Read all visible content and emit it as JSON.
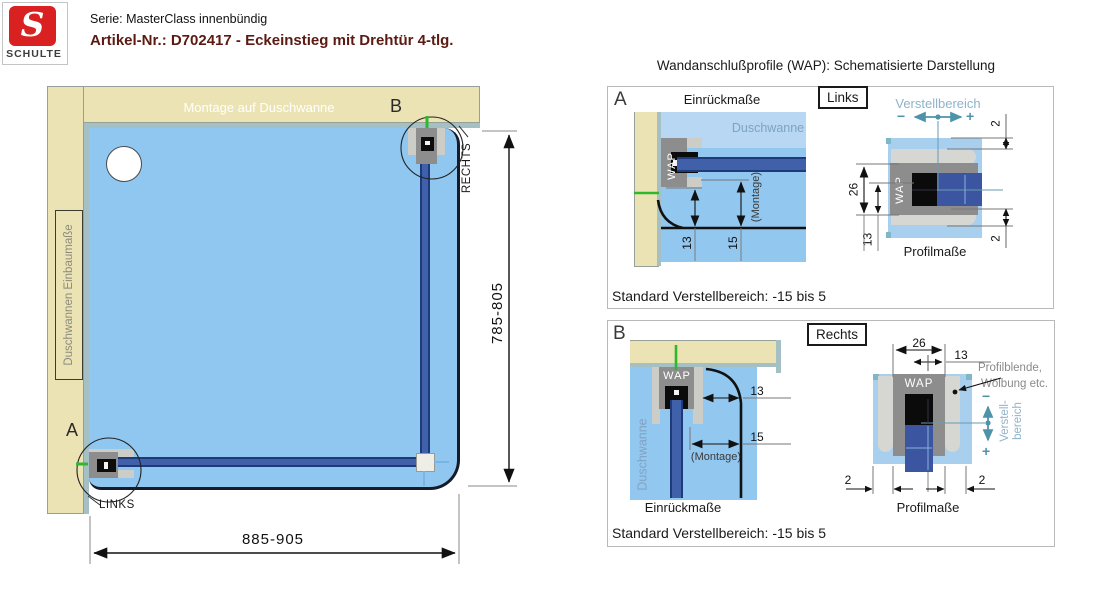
{
  "header": {
    "logo_letter": "S",
    "logo_name": "SCHULTE",
    "serie": "Serie: MasterClass innenbündig",
    "artikel": "Artikel-Nr.: D702417 - Eckeinstieg mit Drehtür 4-tlg."
  },
  "main": {
    "montage": "Montage auf Duschwanne",
    "einbau": "Duschwannen Einbaumaße",
    "a": "A",
    "b": "B",
    "links": "LINKS",
    "rechts": "RECHTS",
    "width_dim": "885-905",
    "height_dim": "785-805"
  },
  "wap": {
    "title": "Wandanschlußprofile (WAP): Schematisierte Darstellung",
    "a": {
      "letter": "A",
      "side": "Links",
      "einrueck": "Einrückmaße",
      "duschwanne": "Duschwanne",
      "wap": "WAP",
      "montage": "(Montage)",
      "d13": "13",
      "d15": "15",
      "verstellbereich": "Verstellbereich",
      "minus": "−",
      "plus": "+",
      "d2_top": "2",
      "d26": "26",
      "d13_profil": "13",
      "d2_bottom": "2",
      "profilmasse": "Profilmaße",
      "note": "Standard Verstellbereich: -15 bis 5"
    },
    "b": {
      "letter": "B",
      "side": "Rechts",
      "einrueck": "Einrückmaße",
      "duschwanne": "Duschwanne",
      "wap": "WAP",
      "montage": "(Montage)",
      "d13": "13",
      "d15": "15",
      "d26": "26",
      "d13_profil": "13",
      "d2_left": "2",
      "d2_right": "2",
      "profilblende": "Profilblende,",
      "woelbung": "Wölbung etc.",
      "verstell1": "Verstell-",
      "verstell2": "bereich",
      "minus": "−",
      "plus": "+",
      "profilmasse": "Profilmaße",
      "note": "Standard Verstellbereich: -15 bis 5"
    }
  },
  "colors": {
    "brand_red": "#d92121",
    "wall_tan": "#ece3b4",
    "tray_blue": "#8fc7f0",
    "panel_blue": "#a9cfee",
    "glass_mid": "#4061aa",
    "glass_edge": "#1d3a7a",
    "profile_gray": "#8d8d8d",
    "blende_gray": "#d6d6d2",
    "teal_edge": "#a4c0c4",
    "accent_teal": "#4e93aa",
    "green": "#2eb82e"
  }
}
